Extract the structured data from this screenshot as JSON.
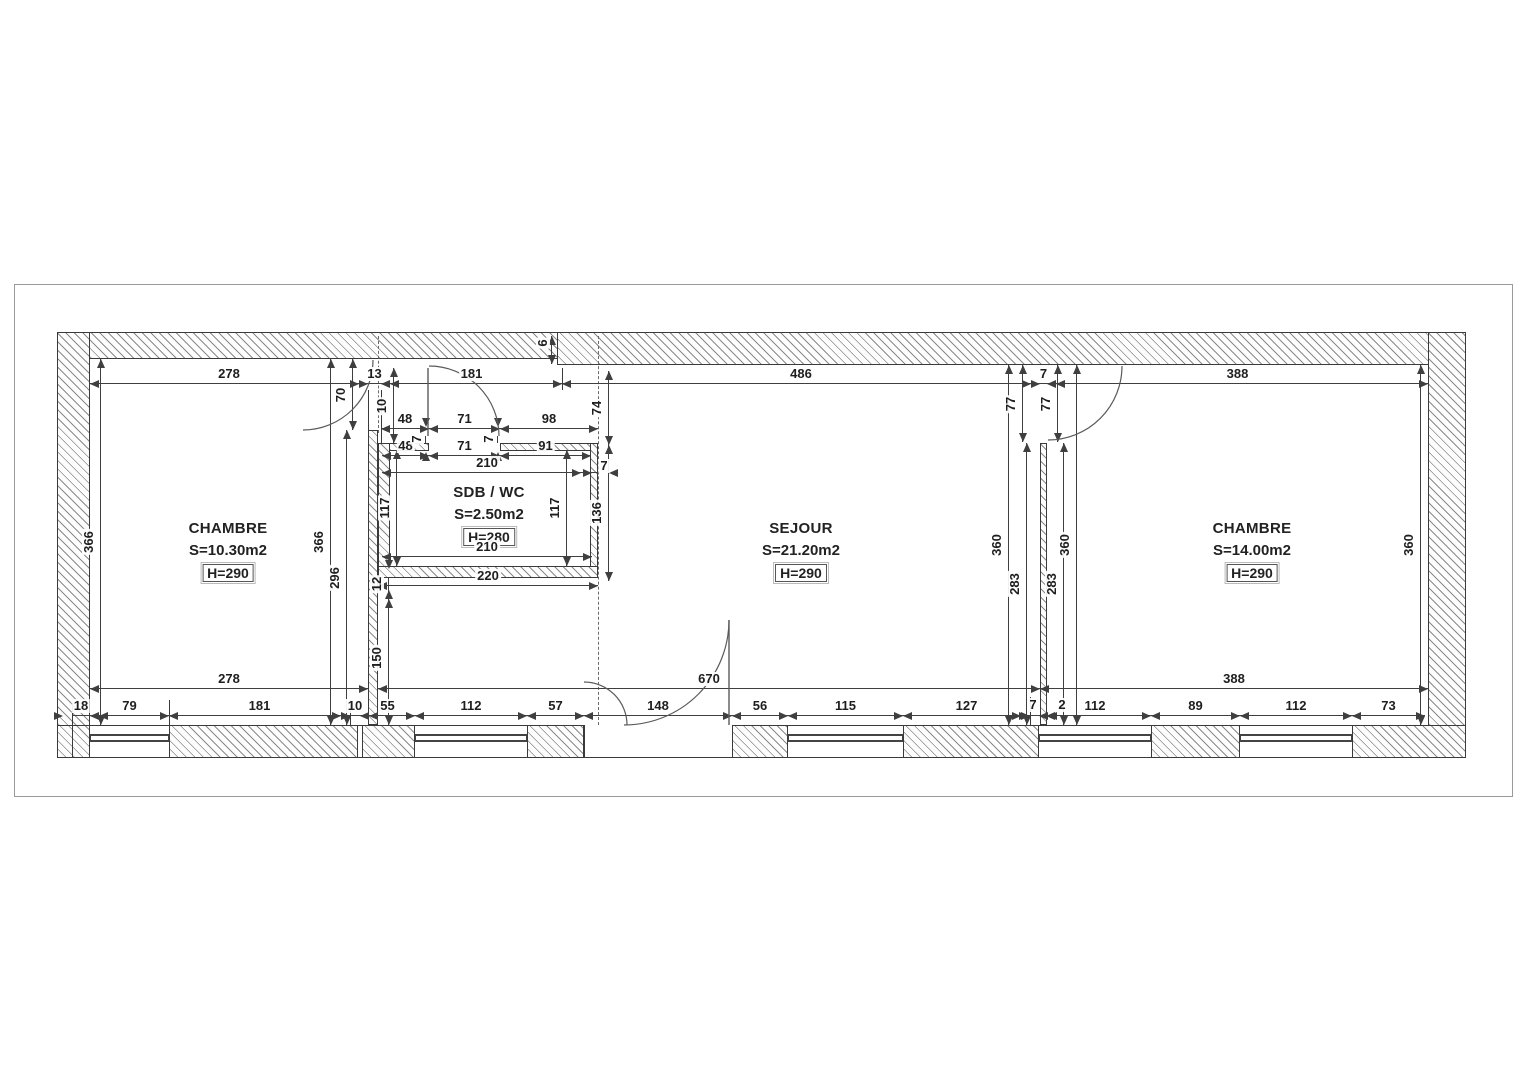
{
  "drawing": {
    "type": "floor-plan",
    "line_color": "#3a3a3a",
    "text_color": "#1e1e1e"
  },
  "rooms": [
    {
      "name": "CHAMBRE",
      "area": "S=10.30m2",
      "height": "H=290",
      "cx": 228,
      "cy": 520
    },
    {
      "name": "SDB / WC",
      "area": "S=2.50m2",
      "height": "H=280",
      "cx": 489,
      "cy": 484
    },
    {
      "name": "SEJOUR",
      "area": "S=21.20m2",
      "height": "H=290",
      "cx": 801,
      "cy": 520
    },
    {
      "name": "CHAMBRE",
      "area": "S=14.00m2",
      "height": "H=290",
      "cx": 1252,
      "cy": 520
    }
  ],
  "dims_h": [
    {
      "label": "278",
      "x1": 90,
      "x2": 368,
      "y": 383
    },
    {
      "label": "13",
      "x1": 368,
      "x2": 381,
      "y": 383
    },
    {
      "label": "181",
      "x1": 381,
      "x2": 562,
      "y": 383
    },
    {
      "label": "486",
      "x1": 562,
      "x2": 1040,
      "y": 383
    },
    {
      "label": "7",
      "x1": 1040,
      "x2": 1047,
      "y": 383
    },
    {
      "label": "388",
      "x1": 1047,
      "x2": 1428,
      "y": 383
    },
    {
      "label": "48",
      "x1": 381,
      "x2": 429,
      "y": 428
    },
    {
      "label": "71",
      "x1": 429,
      "x2": 500,
      "y": 428
    },
    {
      "label": "98",
      "x1": 500,
      "x2": 598,
      "y": 428
    },
    {
      "label": "48",
      "x1": 382,
      "x2": 429,
      "y": 455
    },
    {
      "label": "71",
      "x1": 429,
      "x2": 500,
      "y": 455
    },
    {
      "label": "91",
      "x1": 500,
      "x2": 591,
      "y": 455
    },
    {
      "label": "210",
      "x1": 382,
      "x2": 592,
      "y": 472
    },
    {
      "label": "7",
      "x1": 590,
      "x2": 600,
      "y": 472,
      "lx": 604,
      "ly": 466
    },
    {
      "label": "210",
      "x1": 382,
      "x2": 592,
      "y": 556
    },
    {
      "label": "220",
      "x1": 378,
      "x2": 598,
      "y": 585
    },
    {
      "label": "278",
      "x1": 90,
      "x2": 368,
      "y": 688
    },
    {
      "label": "670",
      "x1": 378,
      "x2": 1040,
      "y": 688
    },
    {
      "label": "388",
      "x1": 1040,
      "x2": 1428,
      "y": 688
    },
    {
      "label": "18",
      "x1": 72,
      "x2": 90,
      "y": 715
    },
    {
      "label": "79",
      "x1": 90,
      "x2": 169,
      "y": 715
    },
    {
      "label": "181",
      "x1": 169,
      "x2": 350,
      "y": 715
    },
    {
      "label": "10",
      "x1": 350,
      "x2": 360,
      "y": 715
    },
    {
      "label": "55",
      "x1": 360,
      "x2": 415,
      "y": 715
    },
    {
      "label": "112",
      "x1": 415,
      "x2": 527,
      "y": 715
    },
    {
      "label": "57",
      "x1": 527,
      "x2": 584,
      "y": 715
    },
    {
      "label": "148",
      "x1": 584,
      "x2": 732,
      "y": 715
    },
    {
      "label": "56",
      "x1": 732,
      "x2": 788,
      "y": 715
    },
    {
      "label": "115",
      "x1": 788,
      "x2": 903,
      "y": 715
    },
    {
      "label": "127",
      "x1": 903,
      "x2": 1030,
      "y": 715
    },
    {
      "label": "7",
      "x1": 1030,
      "x2": 1037,
      "y": 715,
      "lx": 1033,
      "ly": 705
    },
    {
      "label": "2",
      "x1": 1037,
      "x2": 1039,
      "y": 715,
      "lx": 1062,
      "ly": 705
    },
    {
      "label": "112",
      "x1": 1039,
      "x2": 1151,
      "y": 715
    },
    {
      "label": "89",
      "x1": 1151,
      "x2": 1240,
      "y": 715
    },
    {
      "label": "112",
      "x1": 1240,
      "x2": 1352,
      "y": 715
    },
    {
      "label": "73",
      "x1": 1352,
      "x2": 1425,
      "y": 715
    }
  ],
  "dims_v": [
    {
      "label": "366",
      "y1": 359,
      "y2": 725,
      "x": 100
    },
    {
      "label": "366",
      "y1": 359,
      "y2": 725,
      "x": 330
    },
    {
      "label": "296",
      "y1": 430,
      "y2": 725,
      "x": 346
    },
    {
      "label": "70",
      "y1": 359,
      "y2": 430,
      "x": 352
    },
    {
      "label": "10",
      "y1": 368,
      "y2": 443,
      "x": 393
    },
    {
      "label": "74",
      "y1": 371,
      "y2": 445,
      "x": 608
    },
    {
      "label": "136",
      "y1": 445,
      "y2": 581,
      "x": 608
    },
    {
      "label": "117",
      "y1": 450,
      "y2": 566,
      "x": 396
    },
    {
      "label": "117",
      "y1": 450,
      "y2": 566,
      "x": 566
    },
    {
      "label": "7",
      "y1": 436,
      "y2": 443,
      "x": 425,
      "lx": 417,
      "ly": 439
    },
    {
      "label": "7",
      "y1": 436,
      "y2": 443,
      "x": 497,
      "lx": 489,
      "ly": 439
    },
    {
      "label": "12",
      "y1": 578,
      "y2": 590,
      "x": 388
    },
    {
      "label": "150",
      "y1": 590,
      "y2": 725,
      "x": 388
    },
    {
      "label": "6",
      "y1": 336,
      "y2": 364,
      "x": 551,
      "lx": 543,
      "ly": 343
    },
    {
      "label": "77",
      "y1": 365,
      "y2": 442,
      "x": 1022
    },
    {
      "label": "77",
      "y1": 365,
      "y2": 442,
      "x": 1057
    },
    {
      "label": "360",
      "y1": 365,
      "y2": 725,
      "x": 1008
    },
    {
      "label": "283",
      "y1": 443,
      "y2": 725,
      "x": 1026
    },
    {
      "label": "283",
      "y1": 443,
      "y2": 725,
      "x": 1063
    },
    {
      "label": "360",
      "y1": 365,
      "y2": 725,
      "x": 1076
    },
    {
      "label": "360",
      "y1": 365,
      "y2": 725,
      "x": 1420
    }
  ]
}
